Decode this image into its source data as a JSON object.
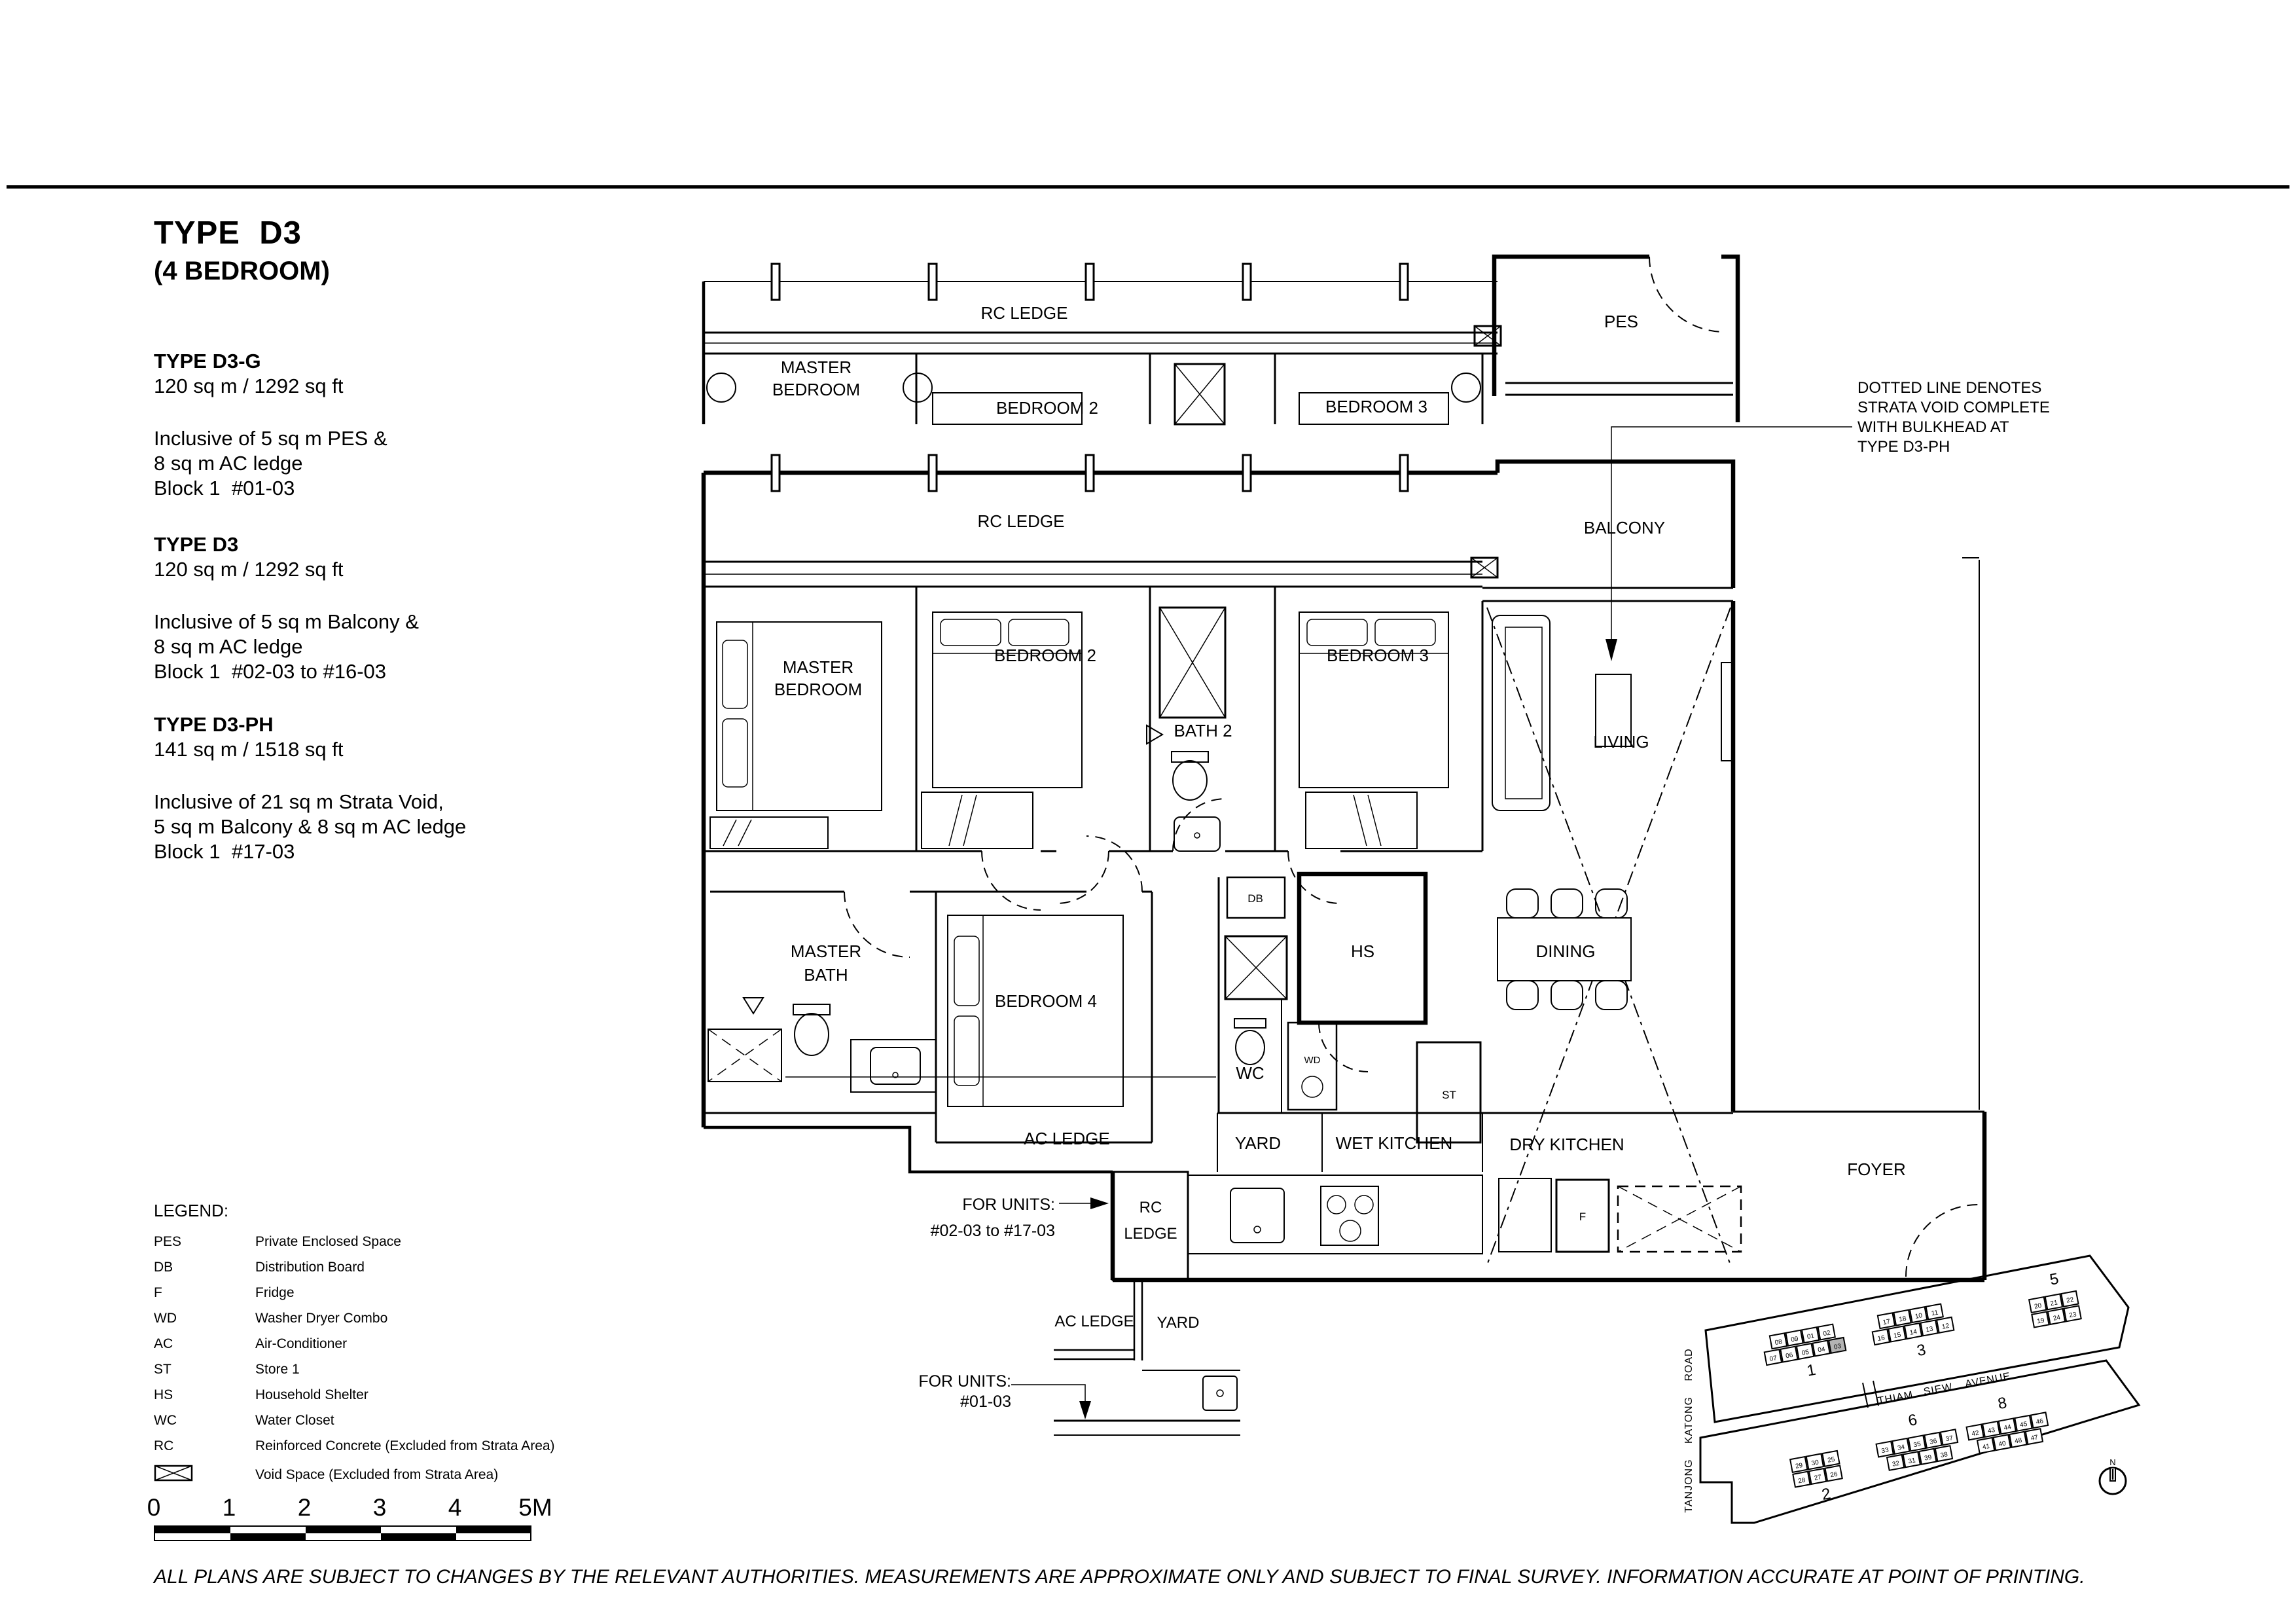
{
  "page": {
    "title": "TYPE  D3",
    "subtitle": "(4 BEDROOM)",
    "disclaimer": "ALL PLANS ARE SUBJECT TO CHANGES BY THE RELEVANT AUTHORITIES. MEASUREMENTS ARE APPROXIMATE ONLY AND SUBJECT TO FINAL SURVEY. INFORMATION ACCURATE AT POINT OF PRINTING."
  },
  "specs": [
    {
      "heading": "TYPE D3-G",
      "area": "120 sq m / 1292 sq ft",
      "lines": [
        "Inclusive of 5 sq m PES &",
        "8 sq m AC ledge",
        "Block 1  #01-03"
      ]
    },
    {
      "heading": "TYPE D3",
      "area": "120 sq m / 1292 sq ft",
      "lines": [
        "Inclusive of 5 sq m Balcony &",
        "8 sq m AC ledge",
        "Block 1  #02-03 to #16-03"
      ]
    },
    {
      "heading": "TYPE D3-PH",
      "area": "141 sq m / 1518 sq ft",
      "lines": [
        "Inclusive of 21 sq m Strata Void,",
        "5 sq m Balcony & 8 sq m AC ledge",
        "Block 1  #17-03"
      ]
    }
  ],
  "note": {
    "lines": [
      "DOTTED LINE DENOTES",
      "STRATA VOID COMPLETE",
      "WITH BULKHEAD AT",
      "TYPE D3-PH"
    ]
  },
  "annotations": {
    "upper": {
      "l1": "FOR UNITS:",
      "l2": "#02-03 to #17-03"
    },
    "lower": {
      "l1": "FOR UNITS:",
      "l2": "#01-03"
    }
  },
  "legend": {
    "title": "LEGEND:",
    "items": [
      {
        "abbr": "PES",
        "desc": "Private Enclosed Space"
      },
      {
        "abbr": "DB",
        "desc": "Distribution Board"
      },
      {
        "abbr": "F",
        "desc": "Fridge"
      },
      {
        "abbr": "WD",
        "desc": "Washer Dryer Combo"
      },
      {
        "abbr": "AC",
        "desc": "Air-Conditioner"
      },
      {
        "abbr": "ST",
        "desc": "Store 1"
      },
      {
        "abbr": "HS",
        "desc": "Household Shelter"
      },
      {
        "abbr": "WC",
        "desc": "Water Closet"
      },
      {
        "abbr": "RC",
        "desc": "Reinforced Concrete (Excluded from Strata Area)"
      }
    ],
    "void_desc": "Void Space (Excluded from Strata Area)"
  },
  "scalebar": {
    "labels": [
      "0",
      "1",
      "2",
      "3",
      "4",
      "5M"
    ]
  },
  "plan_upper": {
    "labels": {
      "rc_ledge": "RC LEDGE",
      "master1": "MASTER",
      "master2": "BEDROOM",
      "bedroom2": "BEDROOM 2",
      "bedroom3": "BEDROOM 3",
      "pes": "PES"
    }
  },
  "plan_main": {
    "labels": {
      "rc_ledge": "RC LEDGE",
      "balcony": "BALCONY",
      "master1": "MASTER",
      "master2": "BEDROOM",
      "bedroom2": "BEDROOM 2",
      "bath2": "BATH 2",
      "bedroom3": "BEDROOM 3",
      "living": "LIVING",
      "mbath1": "MASTER",
      "mbath2": "BATH",
      "bedroom4": "BEDROOM 4",
      "db": "DB",
      "hs": "HS",
      "wc": "WC",
      "wd": "WD",
      "st": "ST",
      "dining": "DINING",
      "ac_ledge": "AC LEDGE",
      "yard": "YARD",
      "wet_kitchen": "WET KITCHEN",
      "dry_kitchen": "DRY KITCHEN",
      "foyer": "FOYER",
      "rc1": "RC",
      "rc2": "LEDGE",
      "f": "F"
    }
  },
  "plan_detail": {
    "labels": {
      "ac_ledge": "AC LEDGE",
      "yard": "YARD"
    }
  },
  "siteplan": {
    "road_v": "TANJONG   KATONG   ROAD",
    "road_h_words": [
      "THIAM",
      "SIEW",
      "AVENUE"
    ],
    "north": "N",
    "highlight_unit": "03",
    "highlight_color": "#b3b3b3",
    "blocks": [
      {
        "label": "1",
        "top": [
          "08",
          "09",
          "01",
          "02"
        ],
        "bottom": [
          "07",
          "06",
          "05",
          "04",
          "03"
        ]
      },
      {
        "label": "3",
        "top": [
          "17",
          "18",
          "10",
          "11"
        ],
        "bottom": [
          "16",
          "15",
          "14",
          "13",
          "12"
        ]
      },
      {
        "label": "5",
        "top": [
          "20",
          "21",
          "22"
        ],
        "bottom": [
          "19",
          "24",
          "23"
        ]
      },
      {
        "label": "2",
        "top": [
          "29",
          "30",
          "25"
        ],
        "bottom": [
          "28",
          "27",
          "26"
        ]
      },
      {
        "label": "6",
        "top": [
          "33",
          "34",
          "35",
          "36",
          "37"
        ],
        "bottom": [
          "32",
          "31",
          "39",
          "38"
        ]
      },
      {
        "label": "8",
        "top": [
          "42",
          "43",
          "44",
          "45",
          "46"
        ],
        "bottom": [
          "41",
          "40",
          "48",
          "47"
        ]
      }
    ]
  }
}
